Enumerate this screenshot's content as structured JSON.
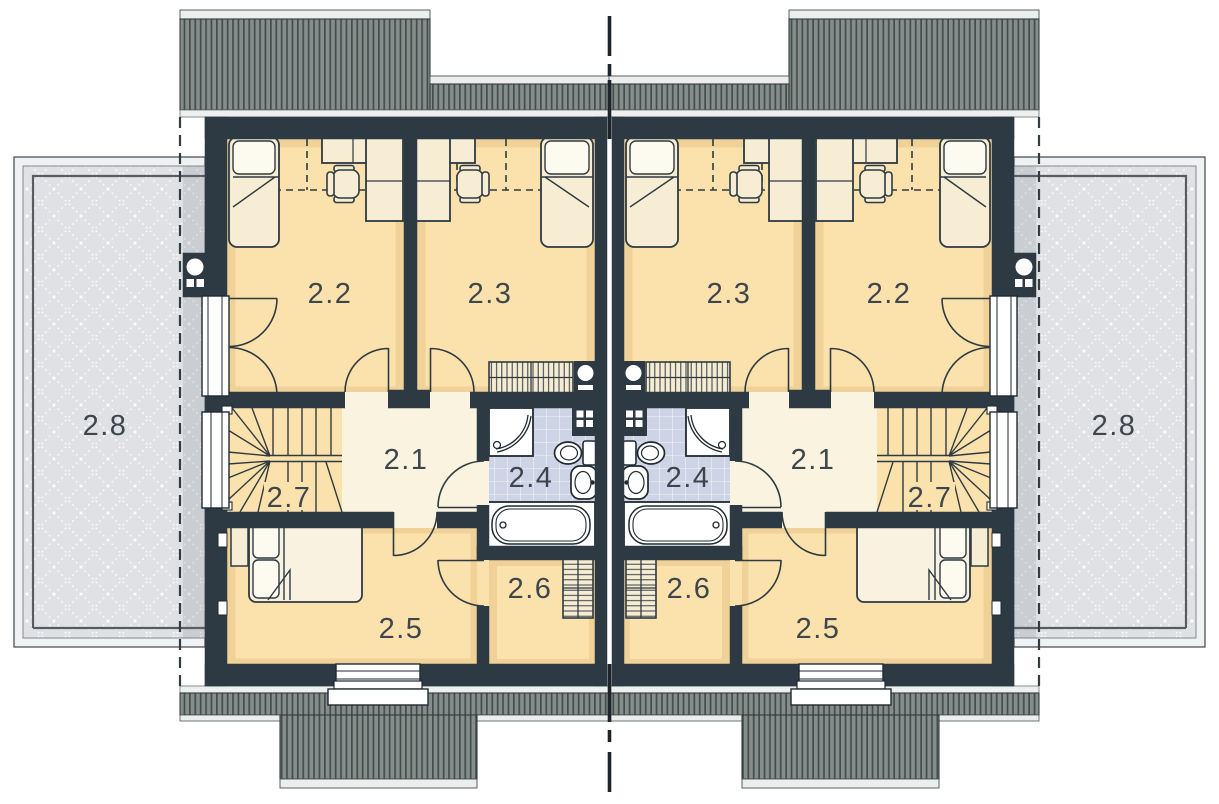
{
  "rooms": {
    "hall": "2.1",
    "bedroom_a": "2.2",
    "bedroom_b": "2.3",
    "bathroom": "2.4",
    "bedroom_c": "2.5",
    "wardrobe_room": "2.6",
    "stairs": "2.7",
    "terrace": "2.8"
  },
  "colors": {
    "wall": "#2d3a43",
    "room_floor": "#fbe2ad",
    "hall_floor": "#faf3e0",
    "bathroom_floor": "#cdd4e6",
    "furniture": "#f7edd5",
    "roof": "#868e8a",
    "roof_stripe": "#434c4f",
    "terrace": "#dfe1e4",
    "label_text": "#3e464d"
  }
}
